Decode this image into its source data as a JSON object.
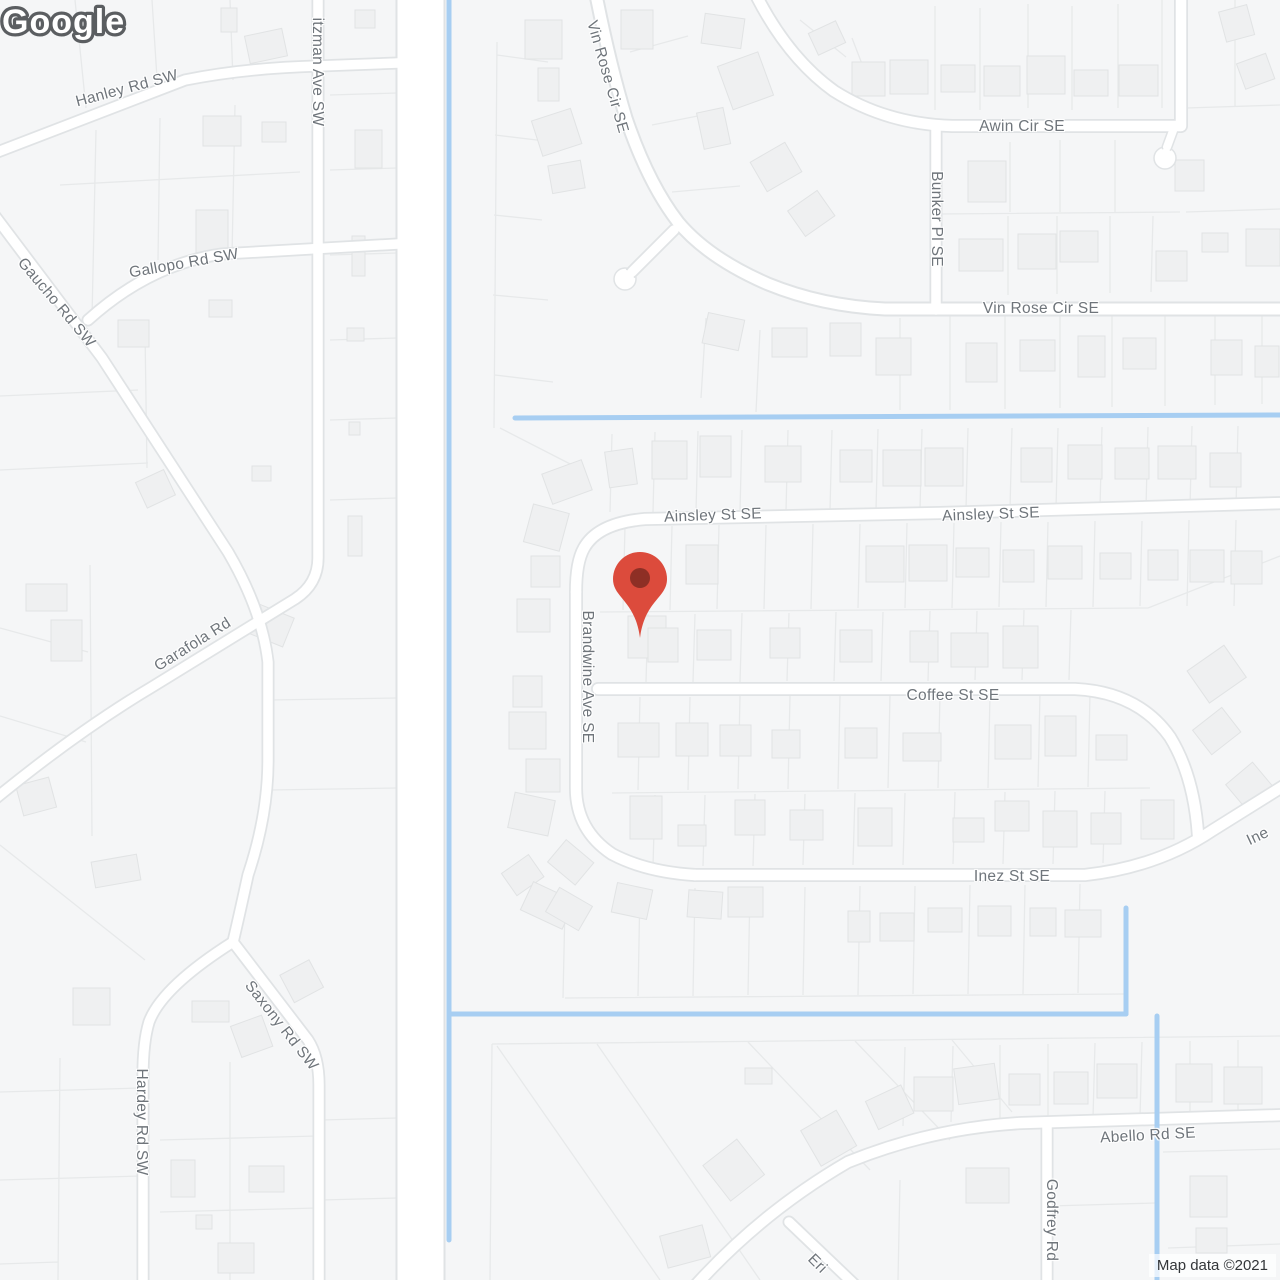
{
  "marker": {
    "name": "location-pin",
    "color": "#DC4B3C",
    "dot_color": "#8E2F25"
  },
  "logo": {
    "text": "Google"
  },
  "attribution": {
    "text": "Map data ©2021"
  },
  "colors": {
    "water": "#A7CEF2",
    "road_fill": "#FFFFFF",
    "road_casing": "#E0E3E5",
    "parcel_line": "#E7E9EA",
    "house_fill": "#EFF0F1",
    "label_text": "#6F757B",
    "background": "#F5F6F7"
  },
  "street_labels": [
    {
      "id": "hanley",
      "text": "Hanley Rd SW"
    },
    {
      "id": "itzman",
      "text": "itzman Ave SW"
    },
    {
      "id": "gaucho",
      "text": "Gaucho Rd SW"
    },
    {
      "id": "gallopo",
      "text": "Gallopo Rd SW"
    },
    {
      "id": "garafola",
      "text": "Garafola Rd"
    },
    {
      "id": "saxony",
      "text": "Saxony Rd SW"
    },
    {
      "id": "hardey",
      "text": "Hardey Rd SW"
    },
    {
      "id": "vin-rose-top",
      "text": "Vin Rose Cir SE"
    },
    {
      "id": "awin",
      "text": "Awin Cir SE"
    },
    {
      "id": "bunker",
      "text": "Bunker Pl SE"
    },
    {
      "id": "vin-rose-mid",
      "text": "Vin Rose Cir SE"
    },
    {
      "id": "ainsley-west",
      "text": "Ainsley St SE"
    },
    {
      "id": "ainsley-east",
      "text": "Ainsley St SE"
    },
    {
      "id": "brandwine",
      "text": "Brandwine Ave SE"
    },
    {
      "id": "coffee",
      "text": "Coffee St SE"
    },
    {
      "id": "inez",
      "text": "Inez St SE"
    },
    {
      "id": "inez-partial",
      "text": "Ine"
    },
    {
      "id": "abello",
      "text": "Abello Rd SE"
    },
    {
      "id": "godfrey",
      "text": "Godfrey Rd"
    },
    {
      "id": "eri-partial",
      "text": "Eri"
    }
  ]
}
